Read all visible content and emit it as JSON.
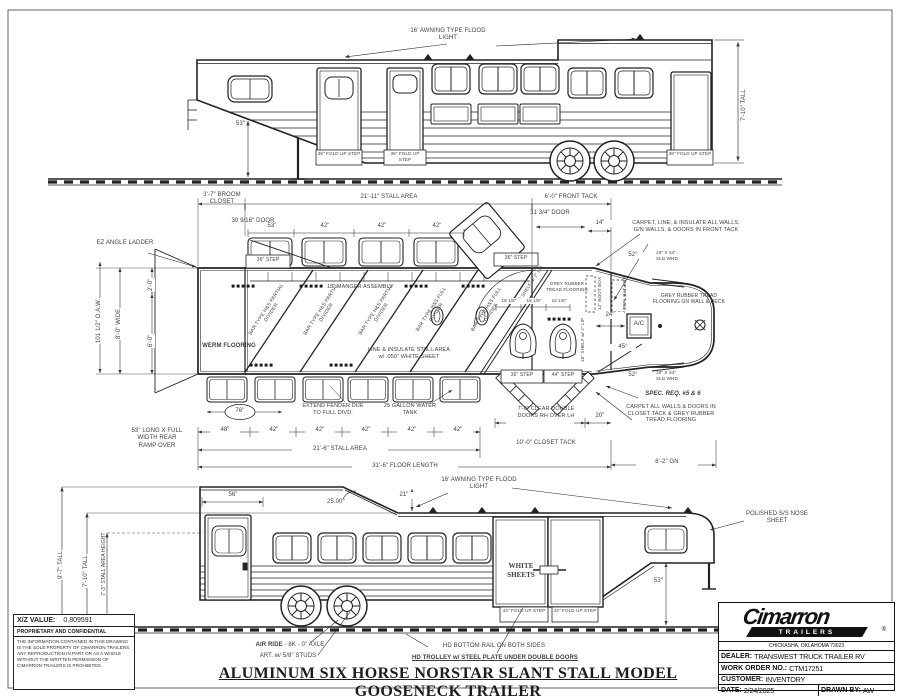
{
  "colors": {
    "ink": "#1c1c1c",
    "text": "#3f3f3f",
    "paper": "#ffffff"
  },
  "title": "ALUMINUM SIX HORSE NORSTAR SLANT STALL MODEL GOOSENECK TRAILER",
  "top": {
    "flood": "16' AWNING TYPE FLOOD LIGHT",
    "gn_drop": "53\"",
    "step1": "36\" FOLD UP STEP",
    "step2": "36\" FOLD UP STEP",
    "step3": "36\" FOLD UP STEP",
    "tall": "7'-10\" TALL"
  },
  "plan": {
    "broom": "3'-7\" BROOM CLOSET",
    "stall_top": "21'-11\" STALL AREA",
    "front_tack": "6'-0\" FRONT TACK",
    "broom_door": "30 9/16\" DOOR",
    "ft_door": "31 3/4\" DOOR",
    "d14": "14\"",
    "step_tl": "36\" STEP",
    "step_tr": "36\" STEP",
    "step_b36": "36\" STEP",
    "step_b44": "44\" STEP",
    "win_dims": [
      "53\"",
      "42\"",
      "42\"",
      "42\""
    ],
    "manger": "18\" MANGER ASSEMBLY",
    "ez": "EZ ANGLE LADDER",
    "d2ft": "2'-0\"",
    "d6ft": "6'-0\"",
    "wide": "8'-0\" WIDE",
    "oaw": "101 1/2\" O.A.W.",
    "werm": "WERM FLOORING",
    "dividers": [
      "BAR TYPE H&S PARTIAL DIVIDER",
      "BAR TYPE H&S PARTIAL DIVIDER",
      "BAR TYPE H&S PARTIAL DIVIDER",
      "BAR TYPE H&S FULL DIVIDER",
      "BAR TYPE H&S FULL DIVIDER"
    ],
    "insulate": "LINE & INSULATE STALL AREA w/ .050\" WHITE SHEET",
    "fender_note": "EXTEND FENDER DUE TO FULL DIVD.",
    "tank": "25 GALLON WATER TANK",
    "fender": "76\"",
    "bot_dims": [
      "48\"",
      "42\"",
      "42\"",
      "42\"",
      "42\"",
      "42\""
    ],
    "stall_bot": "21'-6\" STALL AREA",
    "floor": "31'-6\" FLOOR LENGTH",
    "ramp": "53\" LONG X FULL WIDTH REAR RAMP OVER",
    "dbl_doors": "7'-0\" CLEAR DOUBLE DOORS RH OVER LH",
    "d20": "20\"",
    "closet": "10'-0\" CLOSET TACK",
    "gn": "8'-2\" GN",
    "spec": "SPEC. REQ. #5 & 6",
    "closet_note": "CARPET ALL WALLS & DOORS IN CLOSET TACK & GREY RUBBER TREAD FLOORING",
    "front_note": "CARPET, LINE, & INSULATE ALL WALLS, G/N WALLS, & DOORS IN FRONT TACK",
    "gn_floor": "GREY RUBBER TREAD FLOORING GN WALL & DECK",
    "tread": "GREY RUBBER TREAD FLOORING",
    "a52a": "52°",
    "a52b": "52°",
    "sld_a": "19\" X 34\" SLD WND",
    "sld_b": "19\" X 34\" SLD WND",
    "d24": "24\"",
    "ac": "A/C",
    "a45": "45°",
    "boot": "12\" BOOT BOX",
    "bat": "TRPL BAT BOX",
    "shelf_a": "18\" SHELF w/ 2\" LIP",
    "shelf_b": "18\" SHELF w/ 2\" LIP",
    "rack_dims": [
      "18 1/8\"",
      "18 1/8\"",
      "18 1/8\""
    ]
  },
  "bottom": {
    "t97": "9'-7\" TALL",
    "t710": "7'-10\" TALL",
    "t73": "7'-3\" STALL AREA HEIGHT",
    "d56": "56\"",
    "a25": "25.00°",
    "d21": "21\"",
    "flood": "16' AWNING TYPE FLOOD LIGHT",
    "white": "WHITE SHEETS",
    "step1": "44\" FOLD UP STEP",
    "step2": "44\" FOLD UP STEP",
    "gn53": "53\"",
    "nose": "POLISHED S/S NOSE SHEET"
  },
  "notes": {
    "air_bold": "AIR RIDE",
    "air_rest": " - 8K - 0\" AXLE",
    "art": "ART. w/ 5/8\" STUDS",
    "rail": "HD BOTTOM RAIL ON BOTH SIDES",
    "trolley": "HD TROLLEY w/ STEEL PLATE UNDER DOUBLE DOORS"
  },
  "info": {
    "xz_label": "X/Z VALUE:",
    "xz": "0.809591",
    "prop_title": "PROPRIETARY AND CONFIDENTIAL",
    "prop": "THE INFORMATION CONTAINED IN THIS DRAWING IS THE SOLE PROPERTY OF CIMARRON TRAILERS.  ANY REPRODUCTION IN PART OR AS A WHOLE WITHOUT THE WRITTEN PERMISSION OF CIMARRON TRAILERS IS PROHIBITED."
  },
  "tb": {
    "brand": "Cimarron",
    "sub": "TRAILERS",
    "reg": "®",
    "city": "CHICKASHA, OKLAHOMA 73023",
    "dealer_l": "DEALER:",
    "dealer": "TRANSWEST TRUCK TRAILER RV",
    "wo_l": "WORK ORDER NO.:",
    "wo": "CTM17251",
    "cust_l": "CUSTOMER:",
    "cust": "INVENTORY",
    "date_l": "DATE:",
    "date": "2/24/2025",
    "drawn_l": "DRAWN BY:",
    "drawn": "AW"
  }
}
